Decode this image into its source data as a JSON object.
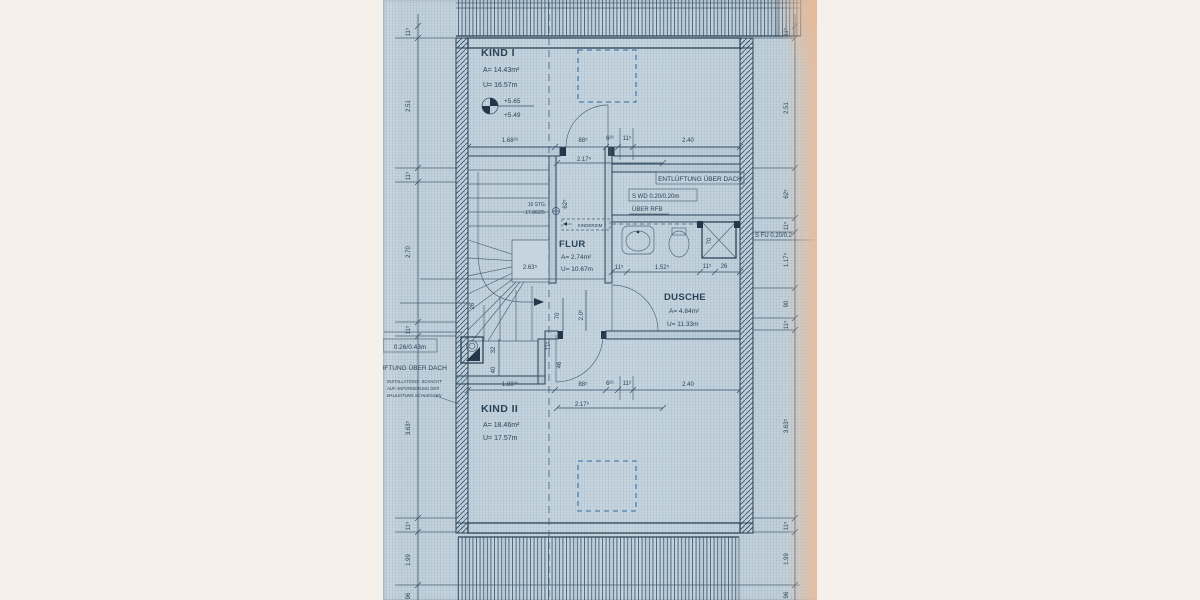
{
  "rooms": {
    "kind1": {
      "name": "KIND I",
      "area": "A= 14.43m²",
      "per": "U= 16.57m"
    },
    "flur": {
      "name": "FLUR",
      "area": "A= 2.74m²",
      "per": "U= 10.67m"
    },
    "dusche": {
      "name": "DUSCHE",
      "area": "A= 4.84m²",
      "per": "U= 11.33m"
    },
    "kind2": {
      "name": "KIND II",
      "area": "A= 18.46m²",
      "per": "U= 17.57m"
    }
  },
  "levels": {
    "upper": "+5.65",
    "lower": "+5.49"
  },
  "annotations": {
    "entl": "ENTLÜFTUNG ÜBER DACH",
    "swd": "S WD 0.20/0.20m",
    "rfb": "ÜBER RFB",
    "sfu": "S FU 0.20/0.2",
    "shaft_size": "0.26/0.43m",
    "left_vent": "LÜFTUNG ÜBER DACH",
    "note1": "INSTALLATIONS- SCHACHT",
    "note2": "AUF ANFORDERUNG DER",
    "note3": "BAULEITUNG SCHLIESSEN",
    "stairs1": "16 STG.",
    "stairs2": "17.86/25",
    "flur_tag": "KINDERZIM"
  },
  "dims": {
    "top": [
      "1.68²⁶",
      "88⁵",
      "6²⁶",
      "11⁵",
      "2.40"
    ],
    "top_sub": "2.17⁵",
    "bottom": [
      "1.88²⁶",
      "88⁵",
      "6²⁶",
      "11⁵",
      "2.40"
    ],
    "bottom_sub": "2.17⁵",
    "bath": [
      "11⁵",
      "1.52⁵",
      "11⁵",
      "26"
    ],
    "left": [
      "11⁵",
      "2.51",
      "11⁵",
      "2.70",
      "11⁵",
      "3.63⁵",
      "11⁵",
      "1.99",
      "96"
    ],
    "right": [
      "11⁵",
      "2.51",
      "62⁵",
      "11⁵",
      "1.17⁵",
      "90",
      "11⁵",
      "3.63⁵",
      "11⁵",
      "1.99",
      "96"
    ],
    "flur": [
      "2.63⁵",
      "62⁵",
      "70",
      "2.0⁵",
      "11⁵",
      "46",
      "32",
      "40",
      "26",
      "70"
    ]
  }
}
